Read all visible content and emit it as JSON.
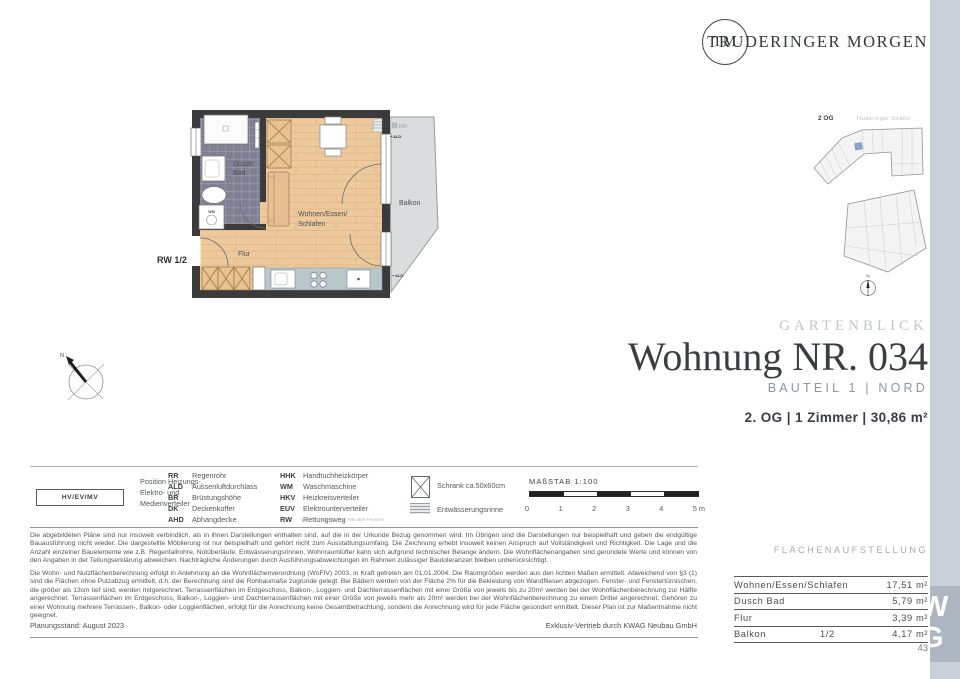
{
  "brand": {
    "logo_initials": "TM",
    "name": "TRUDERINGER MORGEN"
  },
  "site": {
    "floor": "2 OG",
    "street": "Truderinger Straße",
    "north": "N"
  },
  "compass": {
    "label": "N"
  },
  "plan": {
    "bath_line1": "Dusch",
    "bath_line2": "Bad",
    "hall": "Flur",
    "living_line1": "Wohnen/Essen/",
    "living_line2": "Schlafen",
    "balcony": "Balkon",
    "rw": "RW 1/2",
    "rr": "RR",
    "ald_top": "ALD",
    "ald_bottom": "ALD",
    "wm": "WM",
    "wall_label": "HKV/EUV"
  },
  "title_block": {
    "project": "GARTENBLICK",
    "title": "Wohnung NR. 034",
    "subtitle": "BAUTEIL 1 | NORD",
    "details": "2. OG | 1 Zimmer | 30,86 m²"
  },
  "legend": {
    "hv_box": "HV/EV/MV",
    "hv_lines": [
      "Position Heizungs-,",
      "Elektro- und",
      "Medienverteiler"
    ],
    "col1": [
      {
        "abbr": "RR",
        "term": "Regenrohr"
      },
      {
        "abbr": "ALD",
        "term": "Aussenluftdurchlass"
      },
      {
        "abbr": "BR",
        "term": "Brüstungshöhe"
      },
      {
        "abbr": "DK",
        "term": "Deckenkoffer"
      },
      {
        "abbr": "AHD",
        "term": "Abhangdecke"
      }
    ],
    "col2": [
      {
        "abbr": "HHK",
        "term": "Handtuchheizkörper"
      },
      {
        "abbr": "WM",
        "term": "Waschmaschine"
      },
      {
        "abbr": "HKV",
        "term": "Heizkreisverteiler"
      },
      {
        "abbr": "EUV",
        "term": "Elektrounterverteiler"
      },
      {
        "abbr": "RW",
        "term": "Rettungsweg"
      }
    ],
    "col2_note": "(Anleiterstelle wenn 2. RW über Fenster)",
    "symbols": [
      {
        "label": "Schrank ca.50x60cm"
      },
      {
        "label": "Entwässerungsrinne"
      }
    ],
    "scale": {
      "label": "MAßSTAB 1:100",
      "ticks": [
        "0",
        "1",
        "2",
        "3",
        "4",
        "5 m"
      ]
    }
  },
  "disclaimer": {
    "p1": "Die abgebildeten Pläne sind nur insoweit verbindlich, als in ihnen Darstellungen enthalten sind, auf die in der Urkunde Bezug genommen wird. Im Übrigen sind die Darstellungen nur beispielhaft und geben die endgültige Bauausführung nicht wieder. Die dargestellte Möblierung ist nur beispielhaft und gehört nicht zum Ausstattungsumfang. Die Zeichnung erhebt insoweit keinen Anspruch auf Vollständigkeit und Richtigkeit. Die Lage und die Anzahl einzelner Bauelemente wie z.B. Regenfallrohre, Notüberläufe, Entwässerungsrinnen, Wohnraumlüfter kann sich aufgrund technischer Belange ändern. Die Wohnflächenangaben sind gerundete Werte und können von den Angaben in der Teilungserklärung abweichen. Nachträgliche Änderungen durch Ausführungsabweichungen im Rahmen zulässiger Bautoleranzen bleiben unberücksichtigt.",
    "p2": "Die Wohn- und Nutzflächenberechnung erfolgt in Anlehnung an die Wohnflächenverordnung (WoFIV) 2003, in Kraft getreten am 01.01.2004. Die Raumgrößen werden aus den lichten Maßen ermittelt. Abweichend von §3 (1) sind die Flächen ohne Putzabzug ermittelt, d.h. der Berechnung sind die Rohbaumaße zugrunde gelegt. Bei Bädern werden von der Fläche 2% für die Bekleidung von Wandfliesen abgezogen. Fenster- und Fenstertürnischen, die größer als 13cm tief sind, werden mitgerechnet. Terrassenflächen im Erdgeschoss, Balkon-, Loggien- und Dachterrassenflächen mit einer Größe von jeweils bis zu 20m² werden bei der Wohnflächenberechnung zur Hälfte angerechnet. Terrassenflächen im Erdgeschoss, Balkon-, Loggien- und Dachterrassenflächen mit einer Größe von jeweils mehr als 20m² werden bei der Wohnflächenberechnung zu einem Drittel angerechnet. Gehören zu einer Wohnung mehrere Terrassen-, Balkon- oder Loggienflächen, erfolgt für die Anrechnung keine Gesamtbetrachtung, sondern die Anrechnung wird für jede Fläche gesondert ermittelt. Dieser Plan ist zur Maßentnahme nicht geeignet.",
    "planning": "Planungsstand: August 2023",
    "distribution": "Exklusiv-Vertrieb durch KWAG Neubau GmbH"
  },
  "area_table": {
    "title": "FLÄCHENAUFSTELLUNG",
    "rows": [
      {
        "label": "Wohnen/Essen/Schlafen",
        "factor": "",
        "value": "17,51 m²"
      },
      {
        "label": "Dusch Bad",
        "factor": "",
        "value": "5,79 m²"
      },
      {
        "label": "Flur",
        "factor": "",
        "value": "3,39 m²"
      },
      {
        "label": "Balkon",
        "factor": "1/2",
        "value": "4,17 m²"
      }
    ]
  },
  "watermark": {
    "line1": "W",
    "line2": "G"
  },
  "page_number": "43",
  "colors": {
    "accent_strip": "#c9d0d7",
    "highlight_unit": "#8ba6c9",
    "wood": "#edc99e",
    "tile": "#7f8092"
  }
}
